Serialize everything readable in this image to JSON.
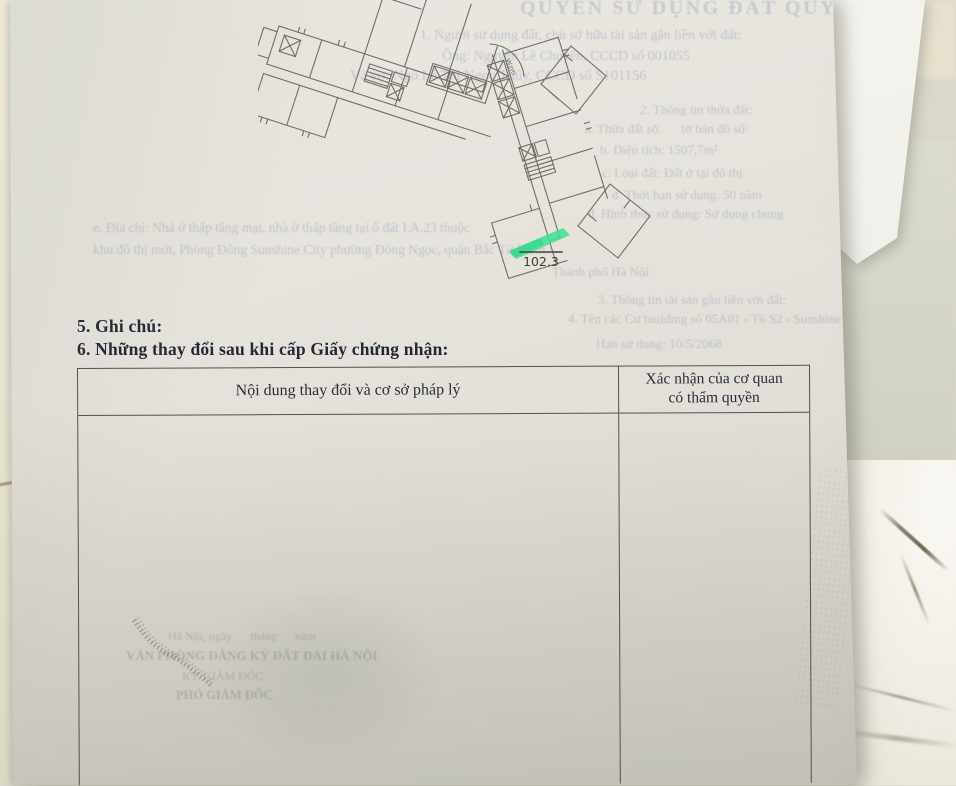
{
  "page": {
    "section5_heading": "5. Ghi chú:",
    "section6_heading": "6. Những thay đổi sau khi cấp Giấy chứng nhận:",
    "table": {
      "col1_header": "Nội dung thay đổi và cơ sở pháp lý",
      "col2_header_line1": "Xác nhận của cơ quan",
      "col2_header_line2": "có thẩm quyền"
    }
  },
  "floor_plan": {
    "area_label": "102.3",
    "north_label": "Wzm",
    "highlight_color": "#3fe08f"
  },
  "ghost": {
    "lines": [
      {
        "text": "QUYỀN SỬ DỤNG ĐẤT QUYỀN SỞ HỮU"
      },
      {
        "text": "1. Người sử dụng đất, chủ sở hữu tài sản gắn liền với đất:"
      },
      {
        "text": "Ông: Nguyễn Lê Chuyên, CCCD số 001055"
      },
      {
        "text": "Và vợ: Ngô Lê Thị Ngọc Thúy, CCCD số S101156"
      },
      {
        "text": "2. Thông tin thửa đất:"
      },
      {
        "text": "a. Thửa đất số:      tờ bản đồ số:"
      },
      {
        "text": "b. Diện tích: 1507,7m²"
      },
      {
        "text": "c. Loại đất: Đất ở tại đô thị"
      },
      {
        "text": "d. Thời hạn sử dụng: 50 năm"
      },
      {
        "text": "đ. Hình thức sử dụng: Sử dụng chung"
      },
      {
        "text": "e. Địa chỉ: Nhà ở thấp tầng mại, nhà ở thấp tầng tại ô đất I.A.23 thuộc"
      },
      {
        "text": "khu đô thị mới, Phòng Đông Sunshine City phường Đông Ngọc, quận Bắc Từ Liêm."
      },
      {
        "text": "Thành phố Hà Nội"
      },
      {
        "text": "3. Thông tin tài sản gắn liền với đất:"
      },
      {
        "text": "4. Tên các Cư building số 05A01 - T6 S2 - Sunshine City"
      },
      {
        "text": "Hạn sử dụng: 10/5/2068"
      },
      {
        "text": "Hà Nội, ngày      tháng      năm"
      },
      {
        "text": "VĂN PHÒNG ĐĂNG KÝ ĐẤT ĐAI HÀ NỘI"
      },
      {
        "text": "KT. GIÁM ĐỐC"
      },
      {
        "text": "PHÓ GIÁM ĐỐC"
      }
    ]
  },
  "colors": {
    "paper": "#e5e3dc",
    "ink": "#242836",
    "table_line": "#53524b",
    "plan_line": "#6f6e67",
    "highlight_green": "#3fe08f",
    "ghost_ink": "#939db2",
    "marble": "#f3f1e9"
  }
}
